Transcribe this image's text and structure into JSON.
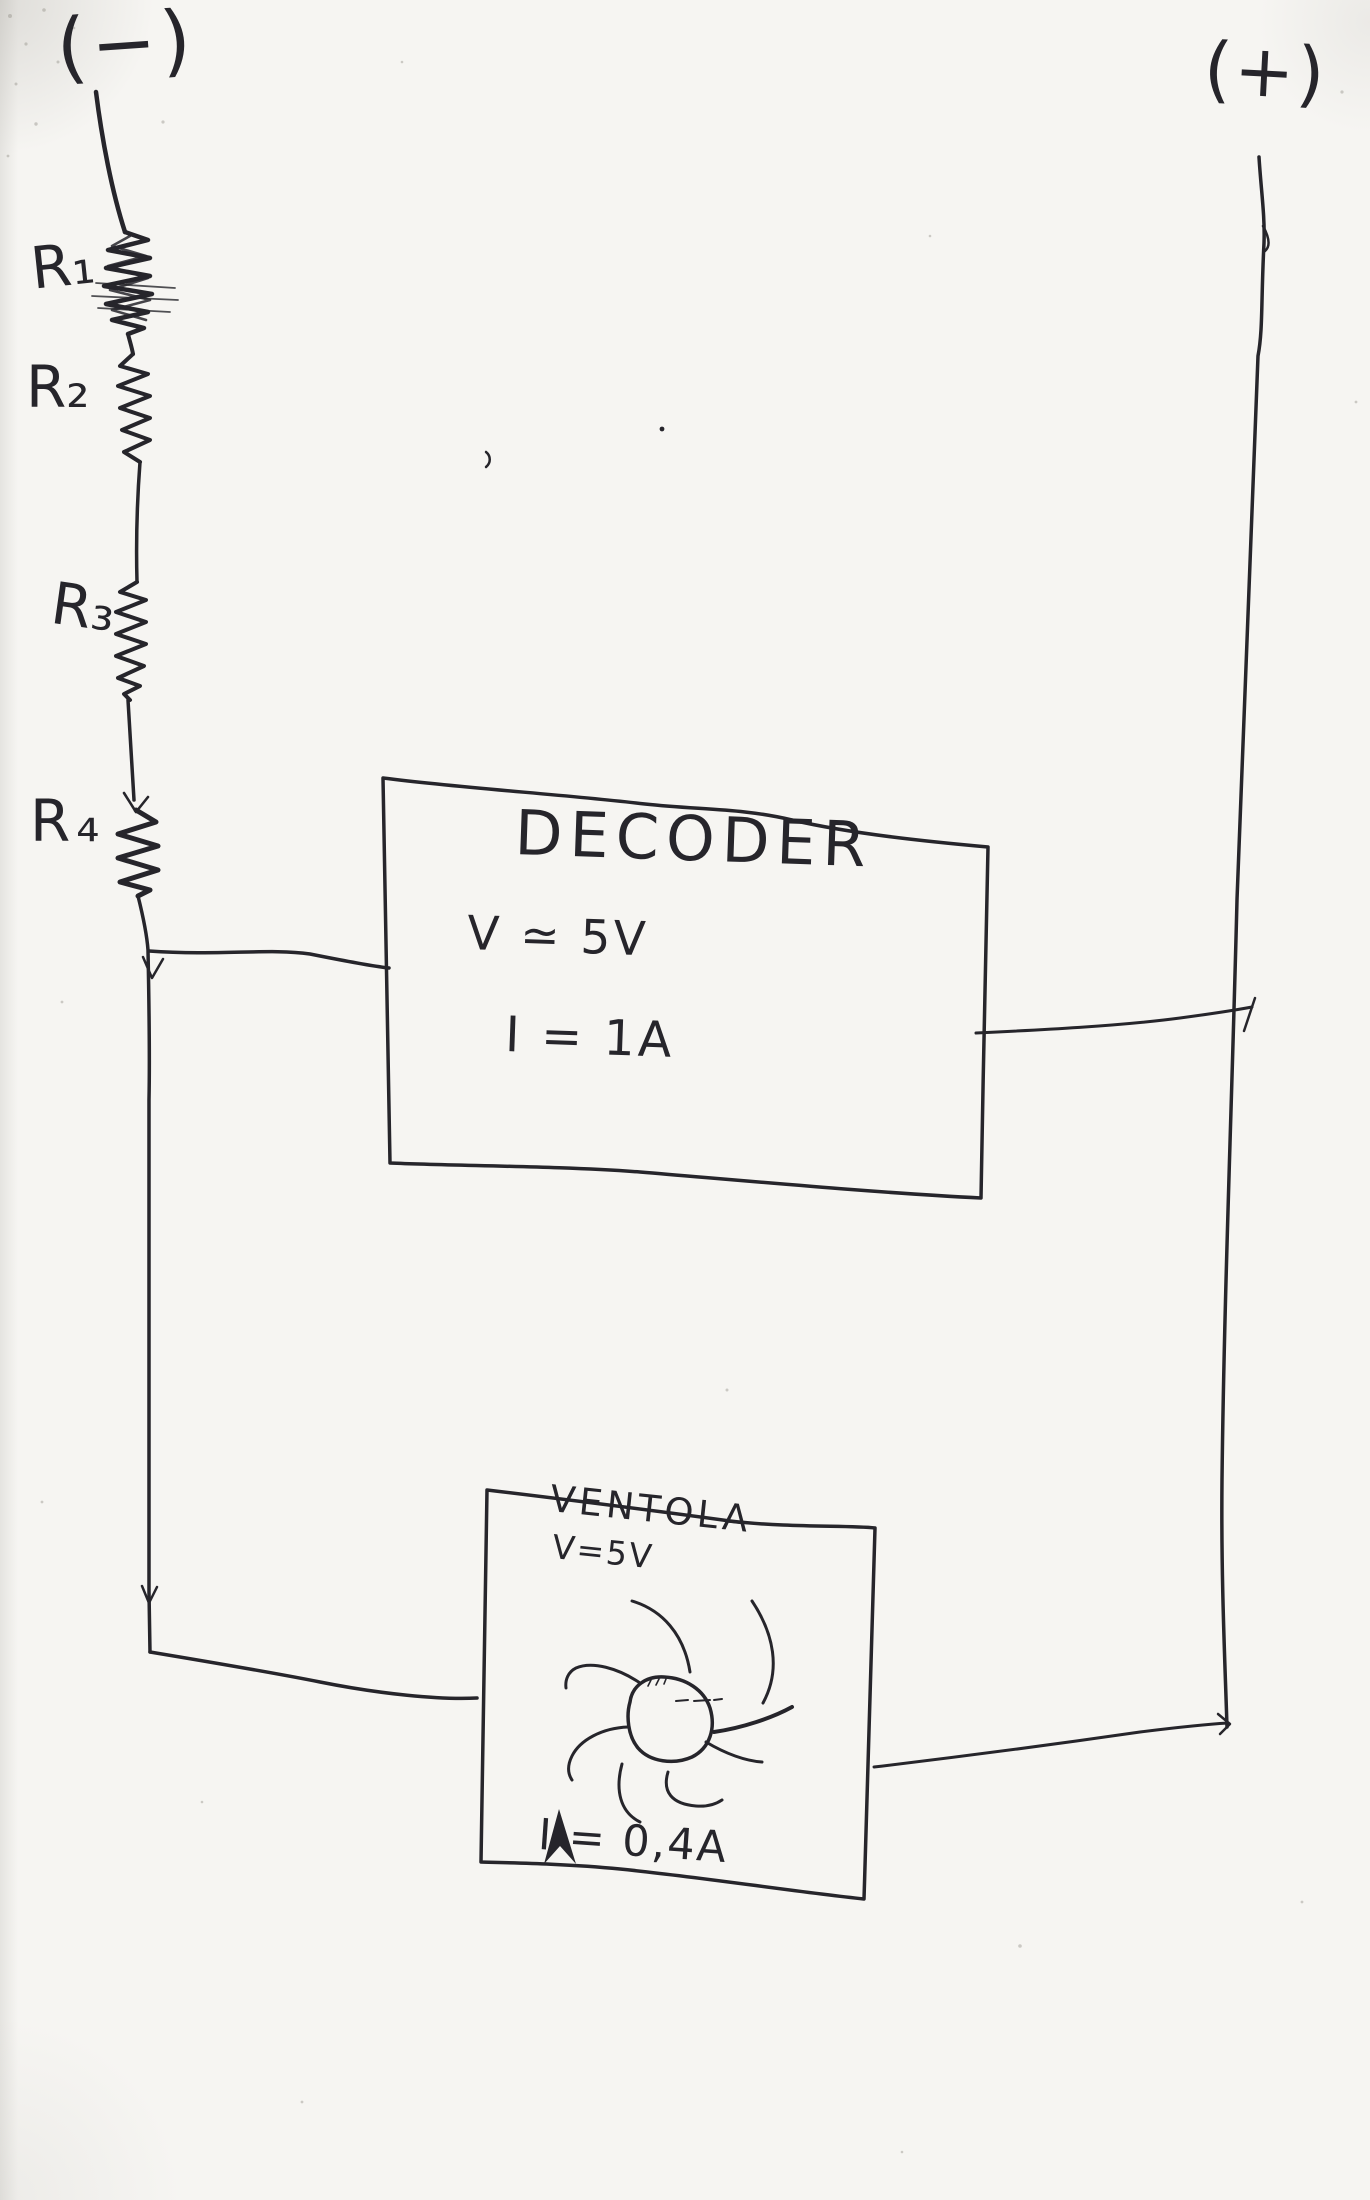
{
  "theme": {
    "ink": "#26252b",
    "paper": "#f6f5f2"
  },
  "circuit": {
    "terminals": {
      "negative": "(−)",
      "positive": "(+)"
    },
    "resistors": [
      {
        "label": "R₁"
      },
      {
        "label": "R₂"
      },
      {
        "label": "R₃"
      },
      {
        "label": "R₄"
      }
    ],
    "decoder": {
      "title": "DECODER",
      "voltage": "V ≃ 5V",
      "current": "I = 1A"
    },
    "fan": {
      "title": "VENTOLA",
      "voltage": "V=5V",
      "current": "I = 0,4A"
    }
  }
}
